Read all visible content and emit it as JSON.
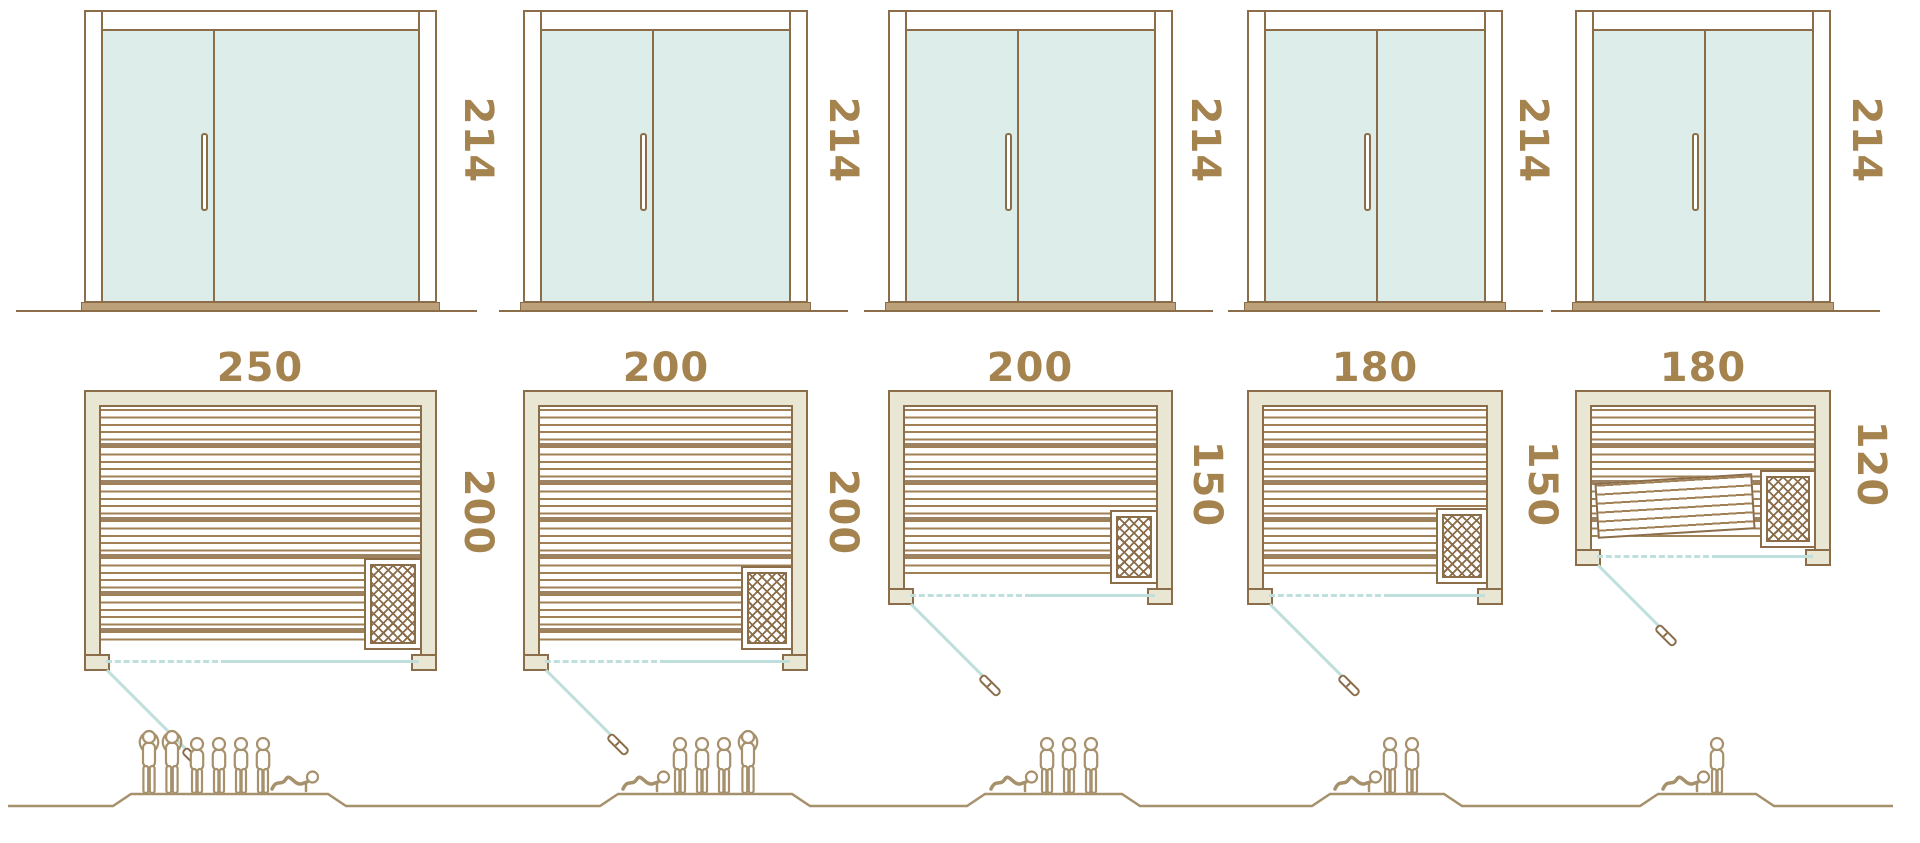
{
  "diagram_title": "Sauna cabin size comparison",
  "palette": {
    "outline_brown": "#8b6d49",
    "slat_brown": "#a08054",
    "label_brown": "#a5834f",
    "wall_beige": "#e9e6d3",
    "glass_teal": "#ddedea",
    "swing_teal": "#bedfdb",
    "figure_tan": "#a6916c",
    "sill_tan": "#bca079"
  },
  "columns": [
    {
      "door_height": "214",
      "width": "250",
      "depth": "200",
      "capacity": {
        "standing": 2,
        "seated": 4,
        "reclining": 1,
        "total": 7
      }
    },
    {
      "door_height": "214",
      "width": "200",
      "depth": "200",
      "capacity": {
        "standing": 1,
        "seated": 3,
        "reclining": 1,
        "total": 5
      }
    },
    {
      "door_height": "214",
      "width": "200",
      "depth": "150",
      "capacity": {
        "standing": 0,
        "seated": 3,
        "reclining": 1,
        "total": 4
      }
    },
    {
      "door_height": "214",
      "width": "180",
      "depth": "150",
      "capacity": {
        "standing": 0,
        "seated": 2,
        "reclining": 1,
        "total": 3
      }
    },
    {
      "door_height": "214",
      "width": "180",
      "depth": "120",
      "capacity": {
        "standing": 0,
        "seated": 1,
        "reclining": 1,
        "total": 2
      }
    }
  ]
}
